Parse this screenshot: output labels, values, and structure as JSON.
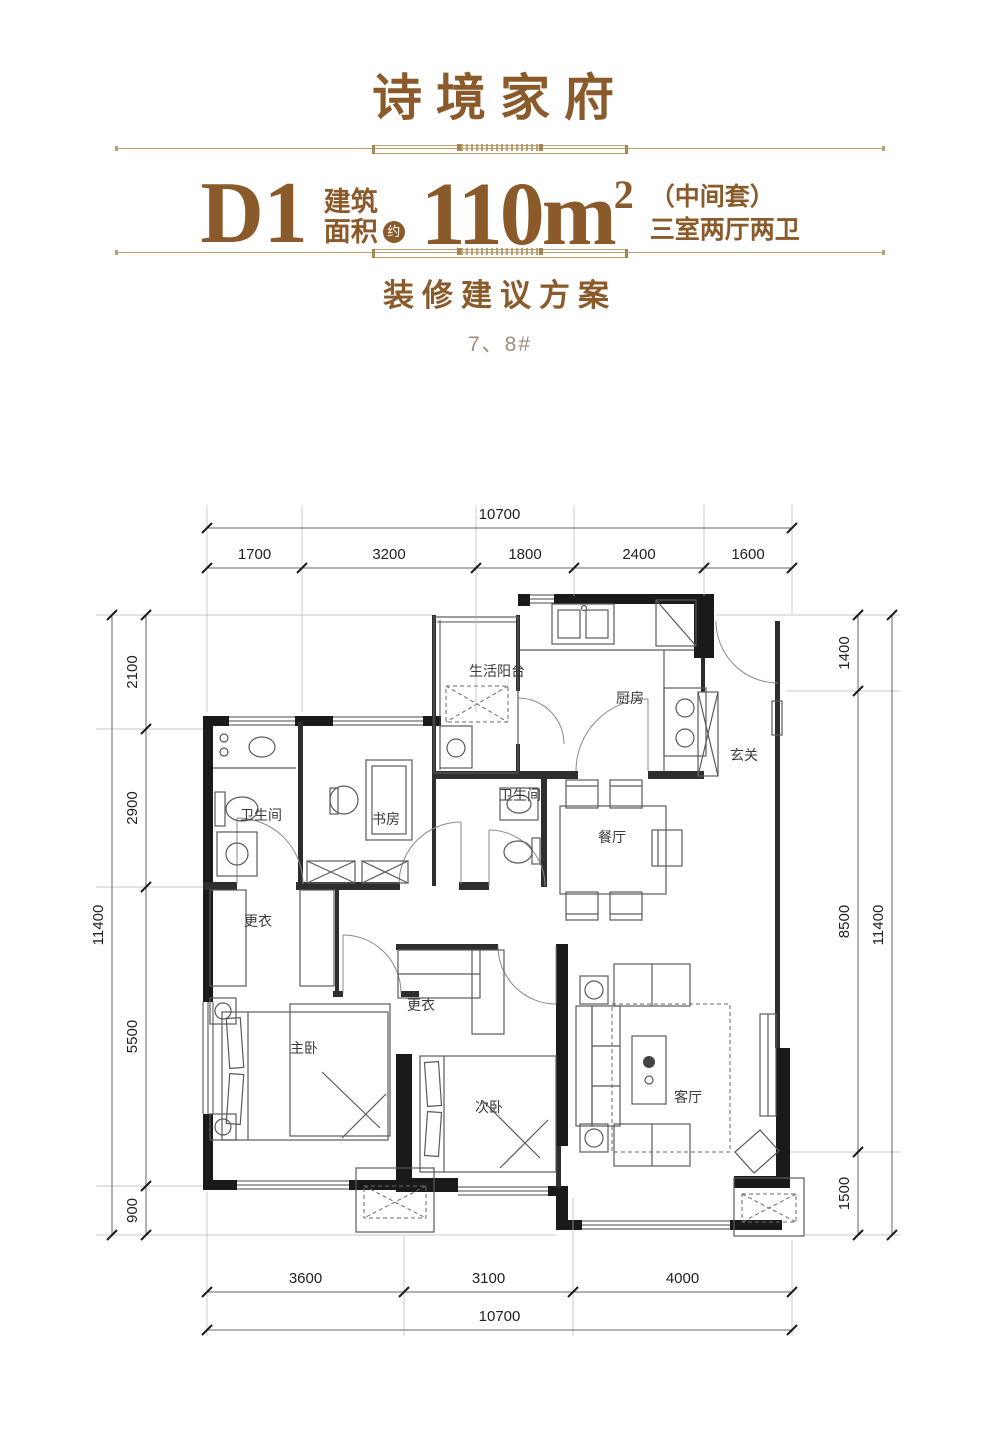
{
  "header": {
    "title": "诗境家府",
    "plan_code": "D1",
    "area_label_top": "建筑",
    "area_label_bottom": "面积",
    "area_approx_badge": "约",
    "area_value": "110m",
    "area_exponent": "2",
    "unit_position": "（中间套）",
    "unit_layout": "三室两厅两卫",
    "subtitle": "装修建议方案",
    "building_numbers": "7、8#"
  },
  "colors": {
    "brand_brown": "#8a5a2b",
    "divider_tan": "#b9a06e",
    "muted_brown": "#9d8d79",
    "wall_black": "#1a1a1a"
  },
  "plan": {
    "rooms": [
      {
        "id": "living-balcony",
        "label": "生活阳台"
      },
      {
        "id": "kitchen",
        "label": "厨房"
      },
      {
        "id": "entry",
        "label": "玄关"
      },
      {
        "id": "bath-1",
        "label": "卫生间"
      },
      {
        "id": "study",
        "label": "书房"
      },
      {
        "id": "bath-2",
        "label": "卫生间"
      },
      {
        "id": "dining",
        "label": "餐厅"
      },
      {
        "id": "dressing-1",
        "label": "更衣"
      },
      {
        "id": "dressing-2",
        "label": "更衣"
      },
      {
        "id": "master-bedroom",
        "label": "主卧"
      },
      {
        "id": "second-bedroom",
        "label": "次卧"
      },
      {
        "id": "living-room",
        "label": "客厅"
      }
    ],
    "dims": {
      "top": {
        "total": "10700",
        "segments": [
          "1700",
          "3200",
          "1800",
          "2400",
          "1600"
        ]
      },
      "bottom": {
        "total": "10700",
        "segments": [
          "3600",
          "3100",
          "4000"
        ]
      },
      "left": {
        "total": "11400",
        "segments": [
          "2100",
          "2900",
          "5500",
          "900"
        ]
      },
      "right": {
        "total": "11400",
        "segments": [
          "1400",
          "8500",
          "1500"
        ]
      }
    }
  }
}
